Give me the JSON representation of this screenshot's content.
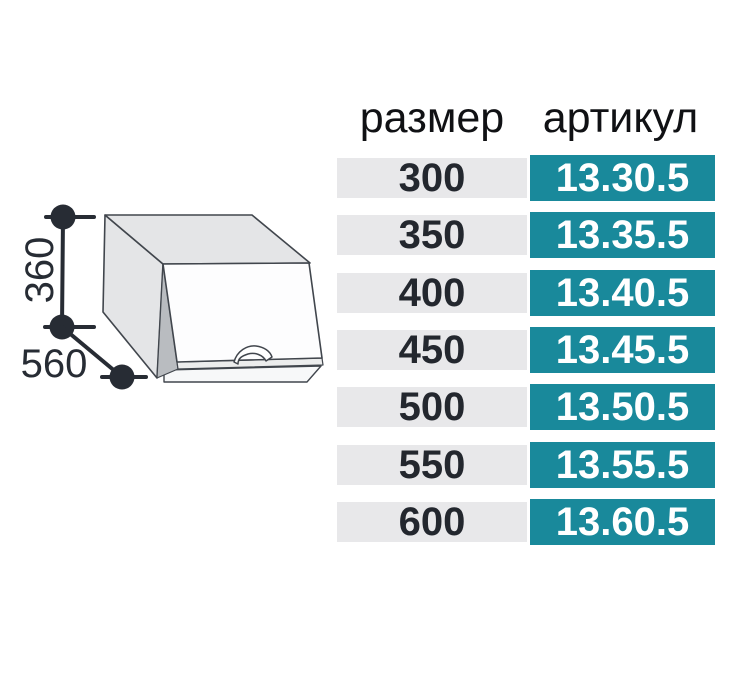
{
  "colors": {
    "accent": "#19899b",
    "row-bg": "#e8e8ea",
    "size-text": "#23272e",
    "article-text": "#ffffff",
    "header-text": "#101114",
    "dim": "#272c34",
    "stroke": "#41464d",
    "face-fill": "#e4e5e7",
    "door-fill": "#fdfdfe",
    "wedge-fill": "#b9bcc0"
  },
  "diagram": {
    "description": "wall cabinet with lift-up door, dimension callouts",
    "height_label": "360",
    "depth_label": "560"
  },
  "table": {
    "headers": {
      "size": "размер",
      "article": "артикул"
    },
    "rows": [
      {
        "size": "300",
        "article": "13.30.5"
      },
      {
        "size": "350",
        "article": "13.35.5"
      },
      {
        "size": "400",
        "article": "13.40.5"
      },
      {
        "size": "450",
        "article": "13.45.5"
      },
      {
        "size": "500",
        "article": "13.50.5"
      },
      {
        "size": "550",
        "article": "13.55.5"
      },
      {
        "size": "600",
        "article": "13.60.5"
      }
    ]
  }
}
